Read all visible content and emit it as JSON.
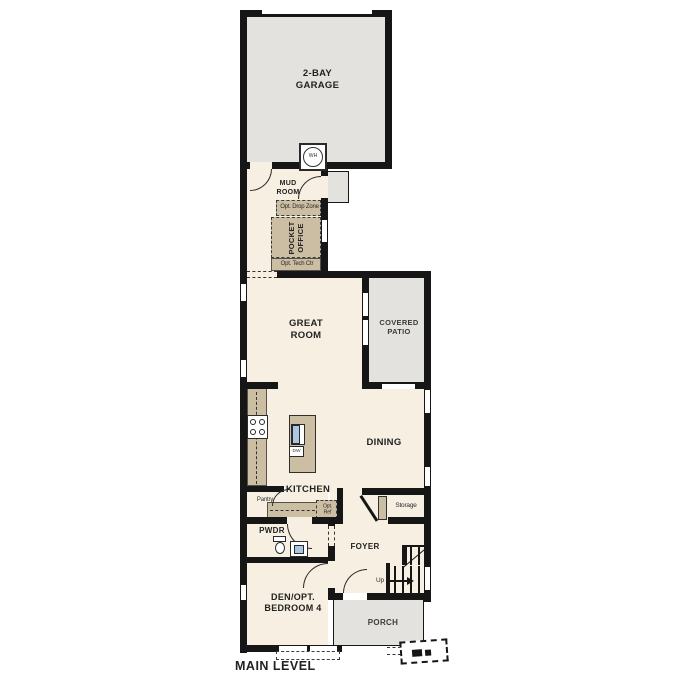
{
  "plan": {
    "title": "MAIN LEVEL"
  },
  "colors": {
    "wall": "#161616",
    "interior": "#f7f0e2",
    "concrete_gray": "#e3e2df",
    "casework_tan": "#ccbea2",
    "fixture_blue": "#a9c6e3"
  },
  "rooms": {
    "garage": "2-BAY\nGARAGE",
    "mud_room": "MUD\nROOM",
    "pocket_office": "POCKET\nOFFICE",
    "great_room": "GREAT\nROOM",
    "covered_patio": "COVERED\nPATIO",
    "dining": "DINING",
    "kitchen": "KITCHEN",
    "pwdr": "PWDR",
    "foyer": "FOYER",
    "den": "DEN/OPT.\nBEDROOM 4",
    "porch": "PORCH"
  },
  "annotations": {
    "drop_zone": "Opt. Drop Zone",
    "tech_ctr": "Opt. Tech Ctr",
    "pantry": "Pantry",
    "opt_ref": "Opt.\nRef",
    "storage": "Storage",
    "up": "Up",
    "water_heater": "WH",
    "dishwasher": "DW"
  }
}
